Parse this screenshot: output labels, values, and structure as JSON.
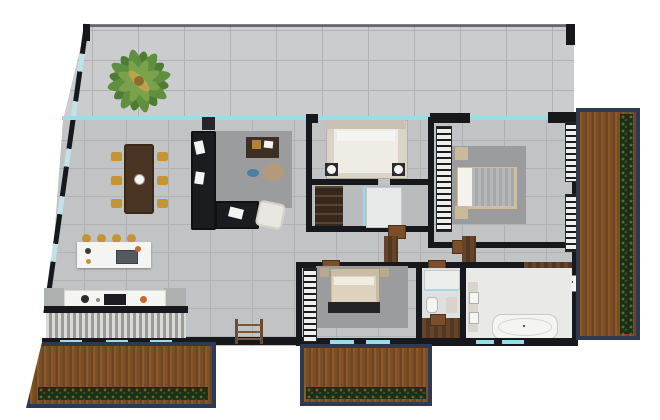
{
  "scene": {
    "type": "apartment-floor-plan-3d-render",
    "view": "top-down",
    "background": "#ffffff"
  },
  "palette": {
    "wall": "#17181b",
    "tile_terrace": "#cbccce",
    "tile_interior": "#c2c3c5",
    "tile_line": "#b1b2b5",
    "glass": "#9fdbe4",
    "deck_wood": "#8a5a2e",
    "deck_frame": "#2e3a52",
    "plants": "#1f2d18",
    "interior_wood": "#5d4026",
    "door_wood": "#7a4f2a",
    "rug": "#9b9c9e",
    "sofa": "#1b1c1f",
    "dining_table": "#4a3524",
    "chair_gold": "#c49436",
    "counter_white": "#f4f4f2",
    "bed_linen": "#efece6",
    "bath_floor": "#e9e9e7",
    "palm_green": "#5f8f3f",
    "orange_accent": "#c96a2a",
    "cabinet_gray": "#aeb0b0"
  },
  "features": {
    "zones": [
      "terrace",
      "living-dining-kitchen",
      "bedroom-top",
      "bedroom-right",
      "bedroom-bottom",
      "ensuite-bathroom",
      "small-bathroom",
      "large-bathroom",
      "corridor",
      "balcony-left",
      "balcony-middle",
      "deck-right"
    ],
    "icons": [
      "palm-tree-icon",
      "dining-table-icon",
      "sofa-icon",
      "kitchen-island-icon",
      "cooktop-icon",
      "sink-icon",
      "bed-icon",
      "bathtub-icon",
      "toilet-icon",
      "shower-icon",
      "wardrobe-icon",
      "door-icon",
      "window-icon",
      "planter-icon"
    ]
  },
  "counts": {
    "dining_chairs": 6,
    "bar_stools": 4,
    "beds": 3,
    "balconies": 3
  }
}
